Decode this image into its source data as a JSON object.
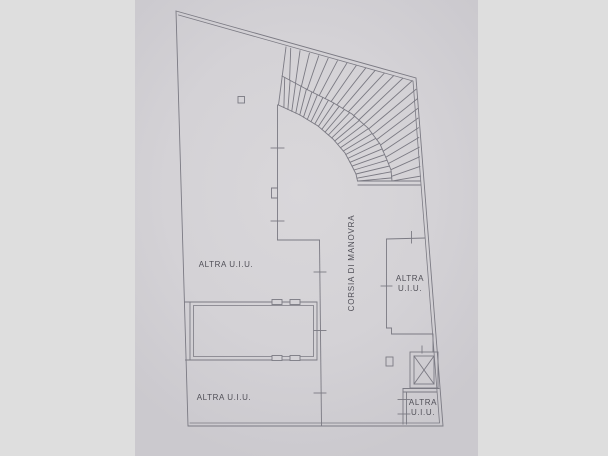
{
  "plan": {
    "rooms": [
      {
        "name": "upper-left",
        "label": "ALTRA U.I.U."
      },
      {
        "name": "lower-left",
        "label": "ALTRA U.I.U."
      },
      {
        "name": "right",
        "label_line1": "ALTRA",
        "label_line2": "U.I.U."
      },
      {
        "name": "corner",
        "label_line1": "ALTRA",
        "label_line2": "U.I.U."
      }
    ],
    "corridor_label": "CORSIA DI MANOVRA"
  },
  "colors": {
    "background": "#dedede",
    "paper": "#d4d2d6",
    "line": "#7b7a83",
    "text": "#504f57"
  }
}
